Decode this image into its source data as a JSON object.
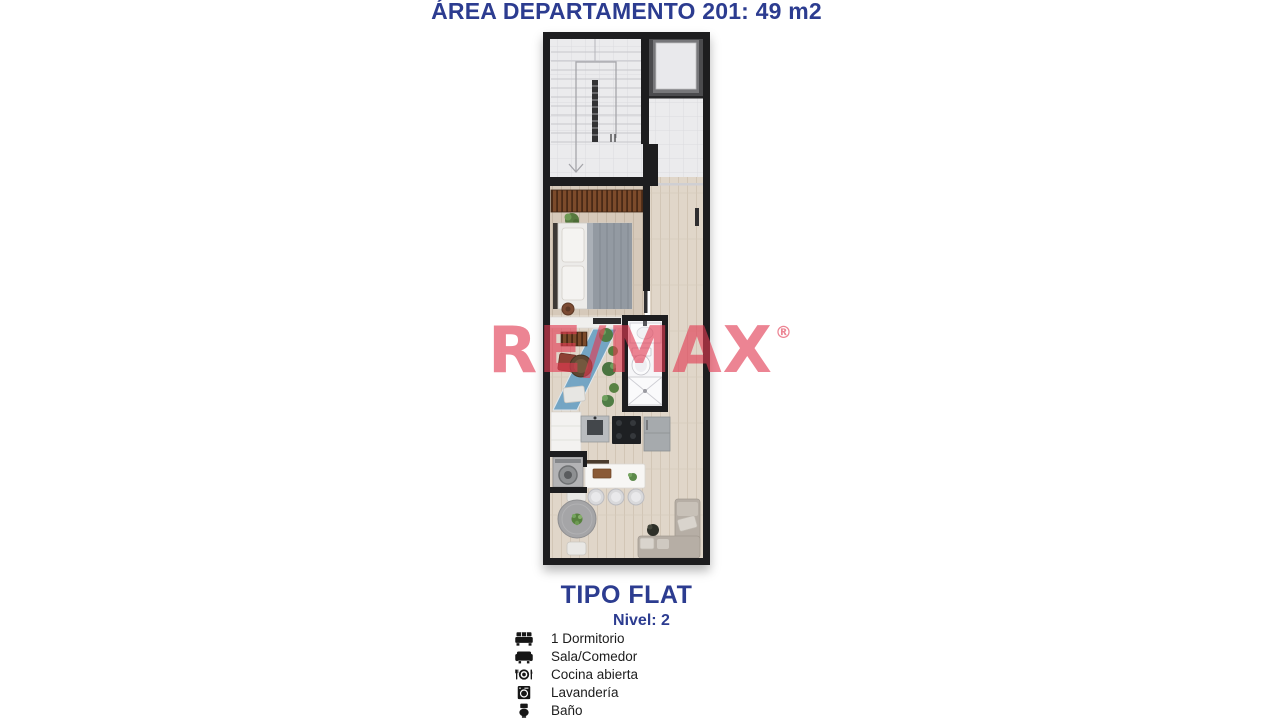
{
  "header": {
    "title": "ÁREA DEPARTAMENTO 201: 49 m2"
  },
  "watermark": {
    "text": "RE/MAX",
    "registered_mark": "®"
  },
  "plan": {
    "caption": {
      "type_label": "TIPO FLAT",
      "level_label": "Nivel: 2"
    },
    "legend": [
      {
        "icon": "bed-icon",
        "label": "1 Dormitorio"
      },
      {
        "icon": "sofa-icon",
        "label": "Sala/Comedor"
      },
      {
        "icon": "cutlery-icon",
        "label": "Cocina abierta"
      },
      {
        "icon": "washing-machine-icon",
        "label": "Lavandería"
      },
      {
        "icon": "toilet-icon",
        "label": "Baño"
      }
    ]
  },
  "colors": {
    "accent_blue": "#2c3c90",
    "watermark_pink": "#e23a52",
    "wall_black": "#1d1d1f",
    "rug_blue": "#6fa3c4",
    "legend_text": "#1c1c1c",
    "tile_gray": "#ebebed",
    "wood_light": "#e0d6c9",
    "wood_bedroom": "#d6c9ba"
  }
}
